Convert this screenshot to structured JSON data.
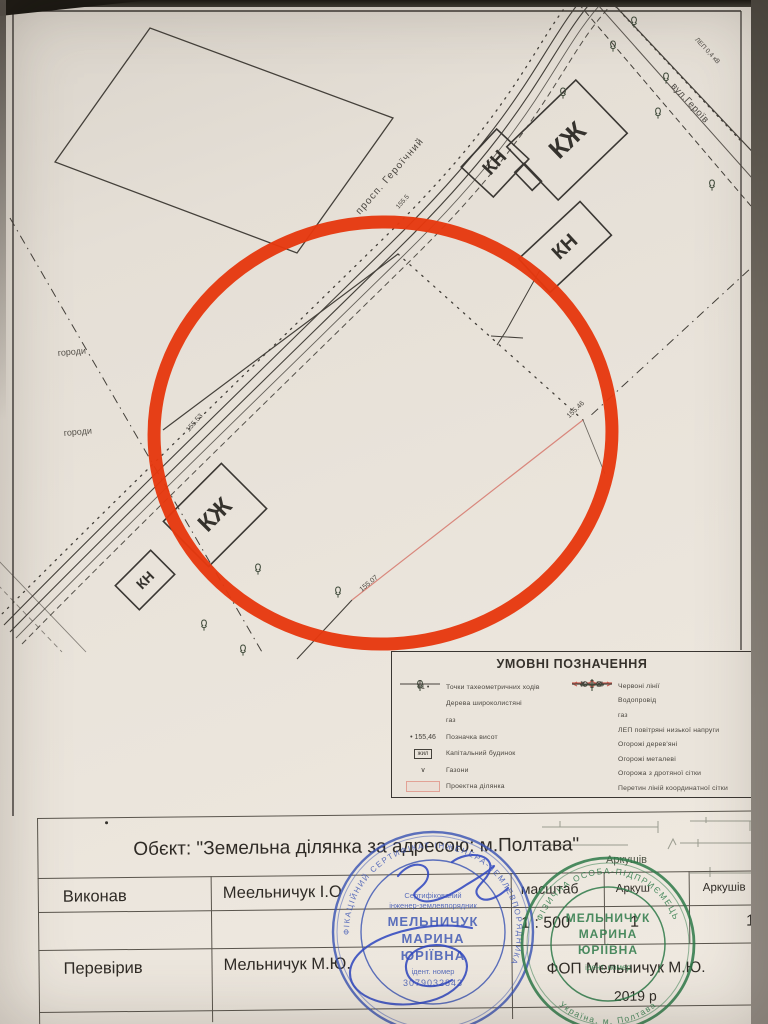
{
  "photo": {
    "paper_color": "#e9e3da",
    "line_color": "#44403a",
    "circle_color": "#e6380f",
    "pink_color": "#d9877c",
    "blue_stamp_color": "#3c55b4",
    "green_stamp_color": "#2e7a49"
  },
  "map": {
    "prospekt_label": "просп. Героїчний",
    "prospekt_elev": "155.5",
    "street_label": "вул.Героїв",
    "lep_label": "ЛЕП 0,4 кВ",
    "garden1": "городи",
    "garden2": "городи",
    "buildings": [
      {
        "text": "КН"
      },
      {
        "text": "КЖ"
      },
      {
        "text": "КН"
      },
      {
        "text": "КЖ"
      },
      {
        "text": "КН"
      }
    ],
    "elevations": [
      {
        "text": "155.53"
      },
      {
        "text": "155.46"
      },
      {
        "text": "155.07"
      }
    ]
  },
  "legend": {
    "title": "УМОВНІ ПОЗНАЧЕННЯ",
    "left": [
      {
        "sym_text": "Т1 •",
        "label": "Точки тахеометричних ходів"
      },
      {
        "sym_text": "",
        "label": "Дерева широколистяні"
      },
      {
        "sym_text": "",
        "label": "газ"
      },
      {
        "sym_text": "• 155,46",
        "label": "Позначка висот"
      },
      {
        "sym_text": "жил",
        "label": "Капітальний будинок"
      },
      {
        "sym_text": "∨",
        "label": "Газони"
      },
      {
        "sym_text": "",
        "label": "Проектна ділянка"
      }
    ],
    "right": [
      {
        "label": "Червоні лінії"
      },
      {
        "label": "Водопровід"
      },
      {
        "label": "газ"
      },
      {
        "label": "ЛЕП повітряні низької напруги"
      },
      {
        "label": "Огорожі дерев'яні"
      },
      {
        "label": "Огорожі металеві"
      },
      {
        "label": "Огорожа з дротяної сітки"
      },
      {
        "label": "Перетин ліній координатної сітки"
      }
    ]
  },
  "titleblock": {
    "object_line": "Обєкт: \"Земельна ділянка за адресою: м.Полтава\"",
    "executed_label": "Виконав",
    "executed_name": "Меельничук І.О",
    "checked_label": "Перевірив",
    "checked_name": "Мельничук М.Ю.",
    "scale_label": "масштаб",
    "scale_value": "1 : 500",
    "sheet_label": "Аркуш",
    "sheet_value": "1",
    "sheets_label": "Аркушів",
    "sheets_value": "1",
    "fop_line": "ФОП Мельничук М.Ю.",
    "year_line": "2019 р"
  },
  "stamps": {
    "blue": {
      "ring_text": "КВАЛІФІКАЦІЙНИЙ СЕРТИФІКАТ ІНЖЕНЕРА-ЗЕМЛЕВПОРЯДНИКА",
      "line1": "Сертифікований",
      "line2": "інженер-землевпорядник",
      "surname": "МЕЛЬНИЧУК",
      "name": "МАРИНА",
      "patronymic": "ЮРІЇВНА",
      "id_label": "ідент. номер",
      "id_number": "3079032843"
    },
    "green": {
      "ring_top": "ФІЗИЧНА ОСОБА-ПІДПРИЄМЕЦЬ",
      "ring_bottom": "Україна, м. Полтава",
      "surname": "МЕЛЬНИЧУК",
      "name": "МАРИНА",
      "patronymic": "ЮРІЇВНА",
      "id_label": "ідент. номер"
    }
  },
  "fragments": {
    "arkushiv": "Аркушів"
  }
}
